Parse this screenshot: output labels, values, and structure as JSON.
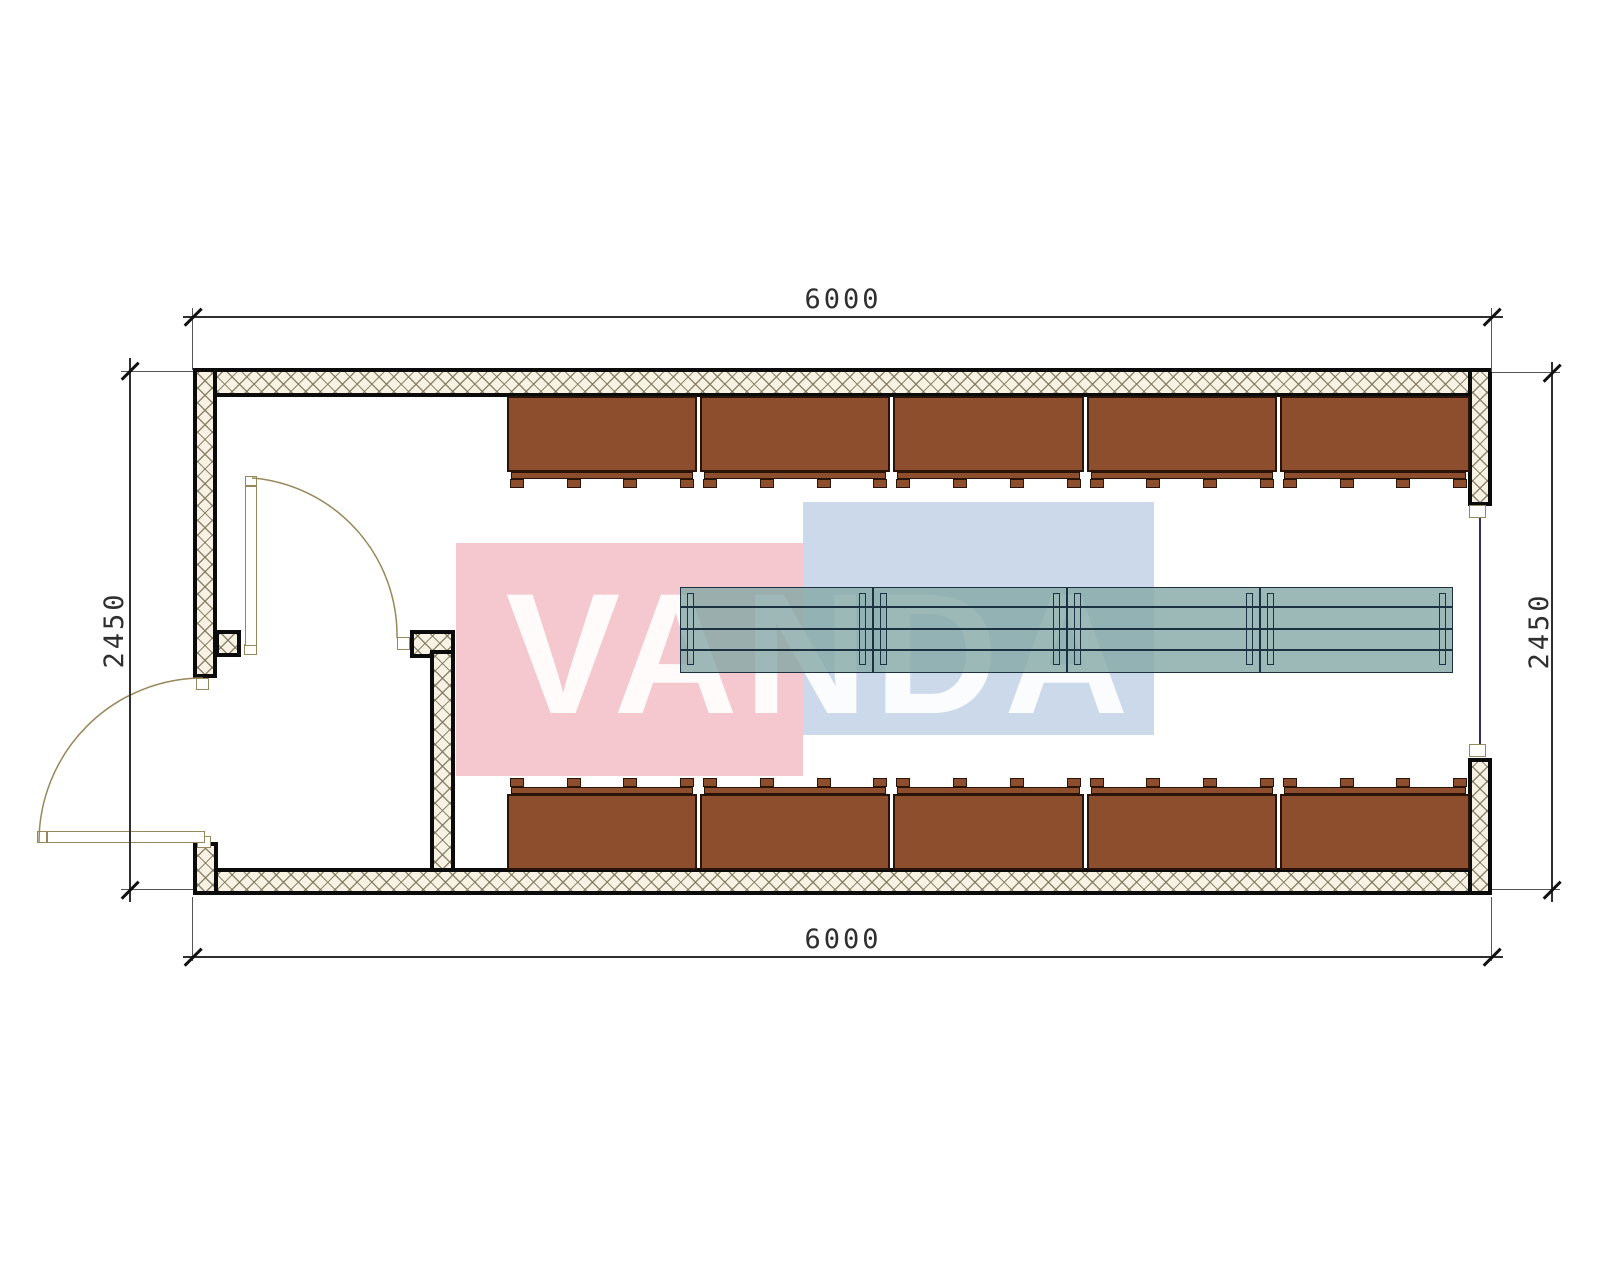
{
  "watermark": {
    "text": "VANDA"
  },
  "dimensions": {
    "top": "6000",
    "bottom": "6000",
    "left": "2450",
    "right": "2450"
  },
  "plan": {
    "cabinets_top_count": 5,
    "cabinets_bottom_count": 5,
    "table_segments": 4,
    "tabs_per_cabinet": 4
  },
  "colors": {
    "wall-fill": "#f7f2e4",
    "hatch-line": "rgba(125,115,90,0.85)",
    "cabinet": "#8d4e2e",
    "cabinet-border": "#2a140a",
    "table-fill": "rgba(133,168,165,0.8)",
    "table-line": "#1c3242",
    "door": "#97875a",
    "dim": "#2f2f2f",
    "window": "#2e2e6b",
    "wm-red": "#f5c7cf",
    "wm-blue": "#ccd9eb"
  }
}
